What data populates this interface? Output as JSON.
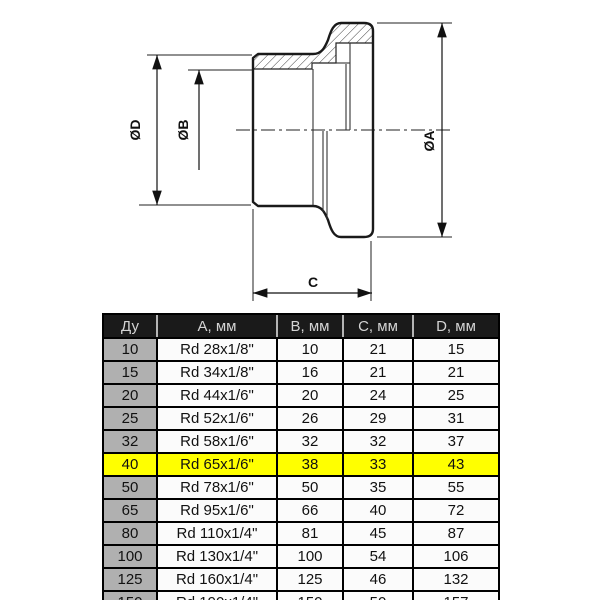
{
  "drawing": {
    "type": "technical-section-drawing",
    "labels": {
      "dia_d": "ØD",
      "dia_b": "ØB",
      "dia_a": "ØA",
      "length_c": "C"
    }
  },
  "table": {
    "headers": [
      "Ду",
      "А, мм",
      "В, мм",
      "С, мм",
      "D, мм"
    ],
    "rows": [
      [
        "10",
        "Rd 28x1/8\"",
        "10",
        "21",
        "15"
      ],
      [
        "15",
        "Rd 34x1/8\"",
        "16",
        "21",
        "21"
      ],
      [
        "20",
        "Rd 44x1/6\"",
        "20",
        "24",
        "25"
      ],
      [
        "25",
        "Rd 52x1/6\"",
        "26",
        "29",
        "31"
      ],
      [
        "32",
        "Rd 58x1/6\"",
        "32",
        "32",
        "37"
      ],
      [
        "40",
        "Rd 65x1/6\"",
        "38",
        "33",
        "43"
      ],
      [
        "50",
        "Rd 78x1/6\"",
        "50",
        "35",
        "55"
      ],
      [
        "65",
        "Rd 95x1/6\"",
        "66",
        "40",
        "72"
      ],
      [
        "80",
        "Rd 110x1/4\"",
        "81",
        "45",
        "87"
      ],
      [
        "100",
        "Rd 130x1/4\"",
        "100",
        "54",
        "106"
      ],
      [
        "125",
        "Rd 160x1/4\"",
        "125",
        "46",
        "132"
      ],
      [
        "150",
        "Rd 190x1/4\"",
        "150",
        "50",
        "157"
      ]
    ],
    "highlight": {
      "row_index": 5,
      "color": "#ffff00"
    },
    "colors": {
      "header_bg": "#1a1a1a",
      "header_text": "#d4d4d4",
      "du_column_bg": "#b0b0b0",
      "cell_bg": "#fbfbfb",
      "border": "#000000"
    }
  }
}
